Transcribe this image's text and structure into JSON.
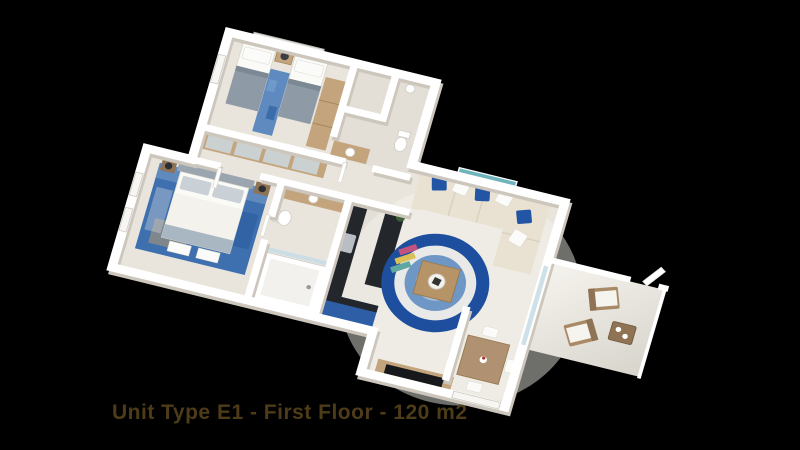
{
  "caption": {
    "text": "Unit Type E1 - First Floor - 120 m2",
    "unit_type": "E1",
    "floor_label": "First Floor",
    "area_label": "120 m2"
  },
  "colors": {
    "background": "#000000",
    "caption_text": "#4d3c17",
    "wall": "#ffffff",
    "wall_shadow": "#ccc6bd",
    "floor": "#e9e5dd",
    "floor_kitchen": "#e3dfd7",
    "floor_balcony": "#f4f2ec",
    "wood": "#c3a47c",
    "wood_dark": "#8f7355",
    "linen": "#fafaf6",
    "bed_gray": "#8e9aa6",
    "rug_blue": "#3e6fae",
    "rug_ring_outer": "#1e4f9f",
    "rug_ring_mid": "#6f97c5",
    "rug_ring_inner": "#a9c0d8",
    "sofa_beige": "#e9e2d2",
    "pillow_blue": "#2355a5",
    "pillow_white": "#fbfbf9",
    "kitchen_dark": "#23262b",
    "cabinet_blue": "#2e5ea6",
    "art_teal": "#6fb4bd",
    "art_sand": "#d9c8a4",
    "plant_green": "#3c5f35",
    "glass": "#c9dde6"
  },
  "scene": {
    "type": "isometric-3d-floor-plan",
    "view": "aerial-oblique",
    "rooms": [
      {
        "name": "twin-bedroom",
        "items": [
          "twin-bed-left",
          "twin-bed-right",
          "nightstand-with-lamp",
          "blue-runner-rug",
          "wall-art",
          "wardrobe"
        ]
      },
      {
        "name": "guest-bathroom",
        "items": [
          "sink",
          "toilet",
          "vanity"
        ]
      },
      {
        "name": "hallway",
        "items": [
          "built-in-wardrobe-mirror-doors"
        ]
      },
      {
        "name": "master-bedroom",
        "items": [
          "double-bed",
          "nightstand-left",
          "nightstand-right",
          "blue-area-rug",
          "windows",
          "foot-cushions"
        ]
      },
      {
        "name": "ensuite-bathroom",
        "items": [
          "bathtub",
          "toilet",
          "vanity-sink"
        ]
      },
      {
        "name": "kitchen",
        "items": [
          "dark-counter-left",
          "dark-counter-right",
          "blue-base-cabinet",
          "plant"
        ]
      },
      {
        "name": "living-room",
        "items": [
          "l-shaped-sofa",
          "blue-white-throw-pillows",
          "round-blue-rug",
          "coffee-table",
          "tv-console",
          "seascape-wall-art"
        ]
      },
      {
        "name": "dining-area",
        "items": [
          "dining-table",
          "dining-chairs-x4"
        ]
      },
      {
        "name": "balcony",
        "items": [
          "lounge-chair-a",
          "lounge-chair-b",
          "side-table",
          "glass-sliding-door",
          "entry-door"
        ]
      }
    ]
  }
}
